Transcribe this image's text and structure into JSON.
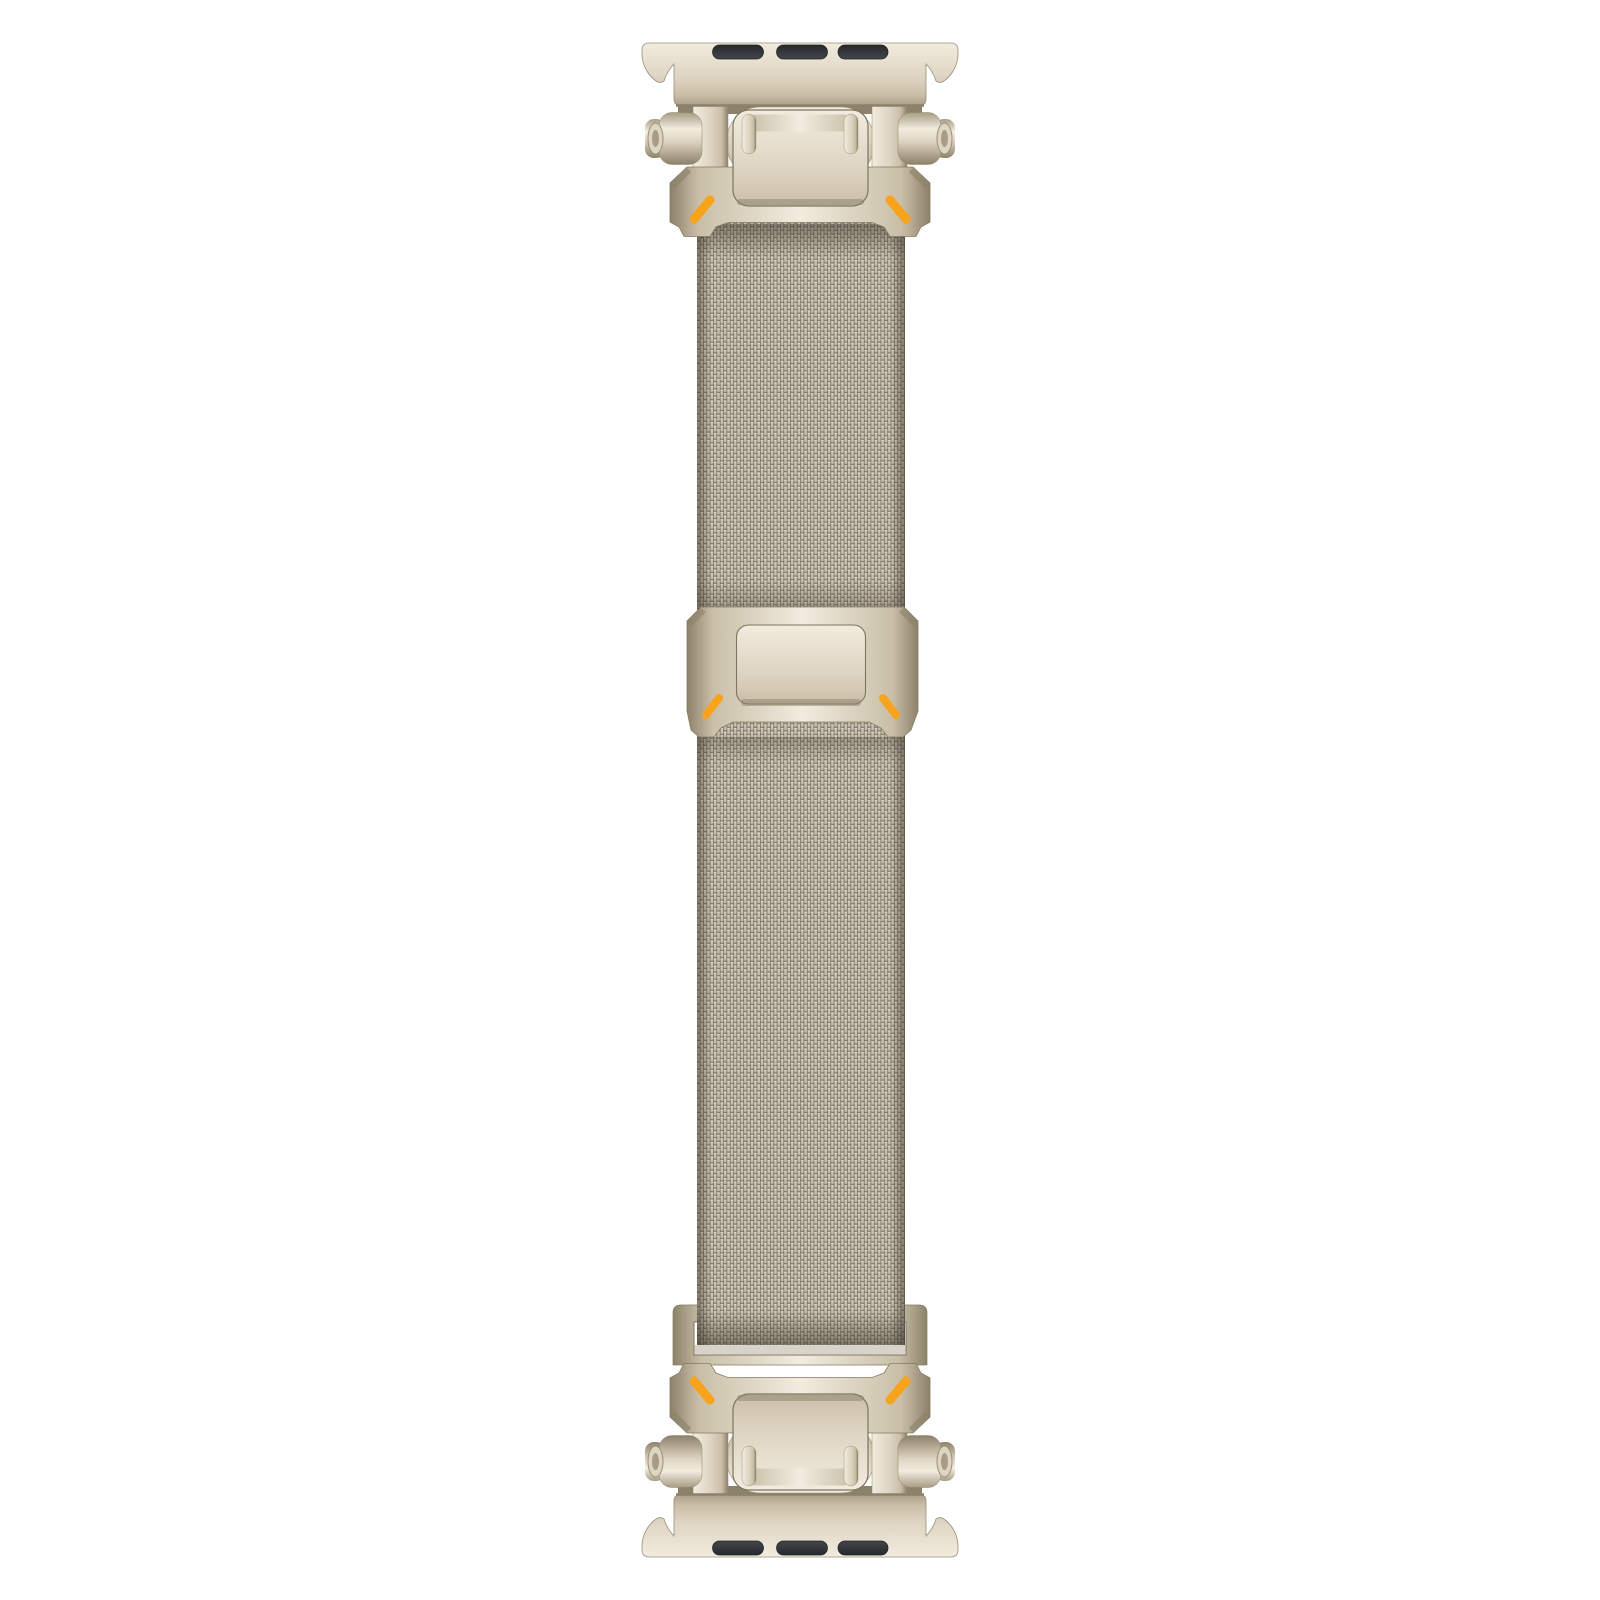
{
  "page": {
    "background": "#ffffff",
    "description": "Product photo of a starlight titanium Milanese loop watch band with rugged orange-accent connectors, displayed vertically on a plain white background"
  },
  "colors": {
    "background": "#ffffff",
    "m1": "#f2ecdf",
    "m2": "#ded4c2",
    "m3": "#c9bfa8",
    "m4": "#a89d84",
    "m5": "#8c8169",
    "edge": "#6f6654",
    "slot_dark": "#26292c",
    "slot_light": "#43474b",
    "orange": "#f7a31c",
    "mesh_dark": "#6b6456",
    "mesh_strand": "#c7bfae",
    "mesh_notch": "#7b7365",
    "mesh_highlight": "#ebe5d6",
    "shadow": "#3a3428"
  },
  "parts": {
    "band": "Milanese loop watch band, starlight titanium finish with orange accents",
    "lug_adapter_top": "Top watch-case lug adapter with flared horns",
    "lug_adapter_bottom": "Bottom watch-case lug adapter with flared horns",
    "spring_bar_slots": "Spring-bar slots in lug adapter",
    "hinge": "Hinge barrel with screw pin end caps",
    "hinge_screw": "Hinge screw pin cap",
    "connector_bracket": "Rugged connector bracket with orange accent marks",
    "accent_marks": "Orange accent dashes",
    "mesh_strap": "Woven stainless Milanese mesh strap",
    "slide_clasp": "Sliding magnetic clasp with raised plate",
    "clasp_plate": "Raised clasp face plate",
    "retainer_frame": "Strap retainer frame loop at adjustable end"
  }
}
